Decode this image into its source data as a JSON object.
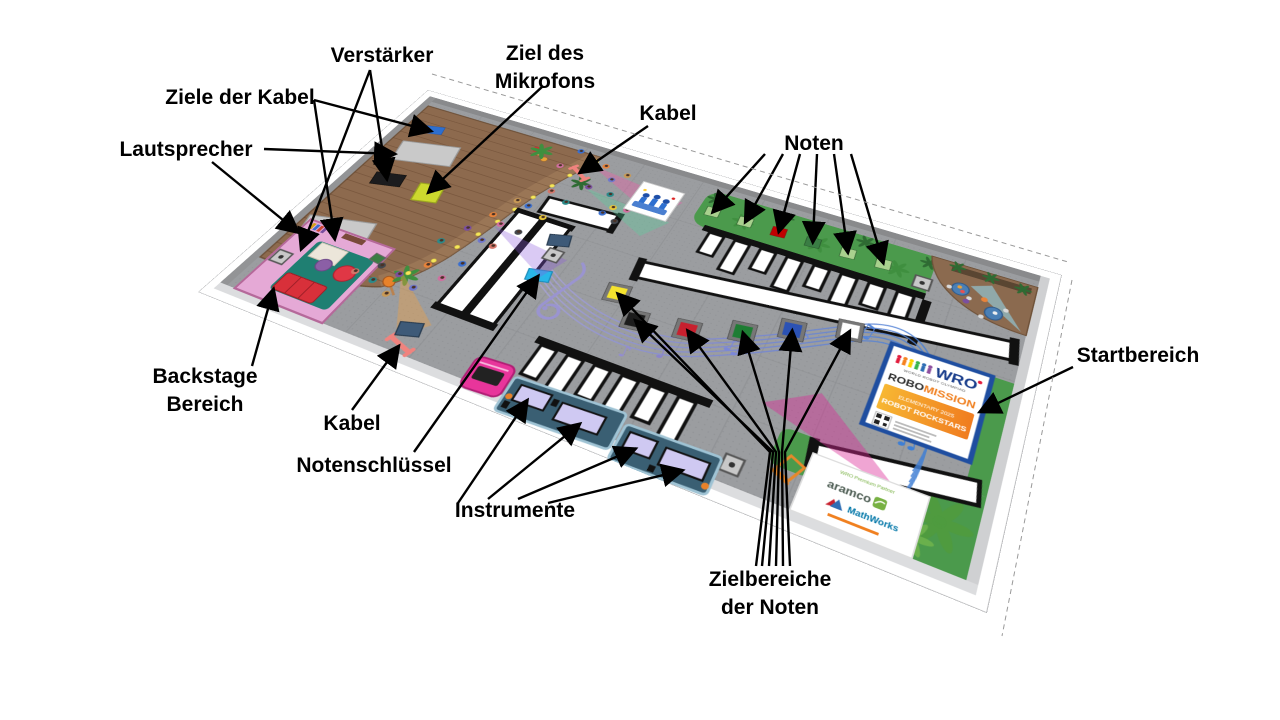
{
  "labels": {
    "verstaerker": {
      "text": "Verstärker"
    },
    "ziele_der_kabel": {
      "text": "Ziele der Kabel"
    },
    "lautsprecher": {
      "text": "Lautsprecher"
    },
    "ziel_des_mikrofons": {
      "line1": "Ziel des",
      "line2": "Mikrofons"
    },
    "kabel_oben": {
      "text": "Kabel"
    },
    "noten": {
      "text": "Noten"
    },
    "startbereich": {
      "text": "Startbereich"
    },
    "backstage": {
      "line1": "Backstage",
      "line2": "Bereich"
    },
    "kabel_unten": {
      "text": "Kabel"
    },
    "notenschluessel": {
      "text": "Notenschlüssel"
    },
    "instrumente": {
      "text": "Instrumente"
    },
    "zielbereiche_der_noten": {
      "line1": "Zielbereiche",
      "line2": "der Noten"
    }
  },
  "start_sign": {
    "wro": "WRO",
    "world": "WORLD ROBOT OLYMPIAD",
    "robo": "ROBO",
    "mission": "MISSION",
    "banner_line1": "ELEMENTARY 2025",
    "banner_line2": "ROBOT ROCKSTARS"
  },
  "sponsor_sign": {
    "partner_line": "WRO Premium Partner",
    "aramco": "aramco",
    "mathworks": "MathWorks"
  },
  "field_colors": {
    "mat": "#9b9da0",
    "stage": "#8d6a4e",
    "grass": "#4b9a4c",
    "backstage": "#e5a9d6",
    "start_sign_border": "#1f4ea0",
    "mission_orange": "#f08020",
    "aramco_green": "#78b143",
    "mathworks_blue": "#0076a8",
    "note_squares": [
      "#a9d18e",
      "#a9d18e",
      "#c00000",
      "#3a7d44",
      "#a9d18e",
      "#a9d18e"
    ],
    "target_squares": [
      "#f5e32e",
      "#1c1c1c",
      "#c8202e",
      "#1e7d33",
      "#2b52b4",
      "#ffffff"
    ]
  }
}
